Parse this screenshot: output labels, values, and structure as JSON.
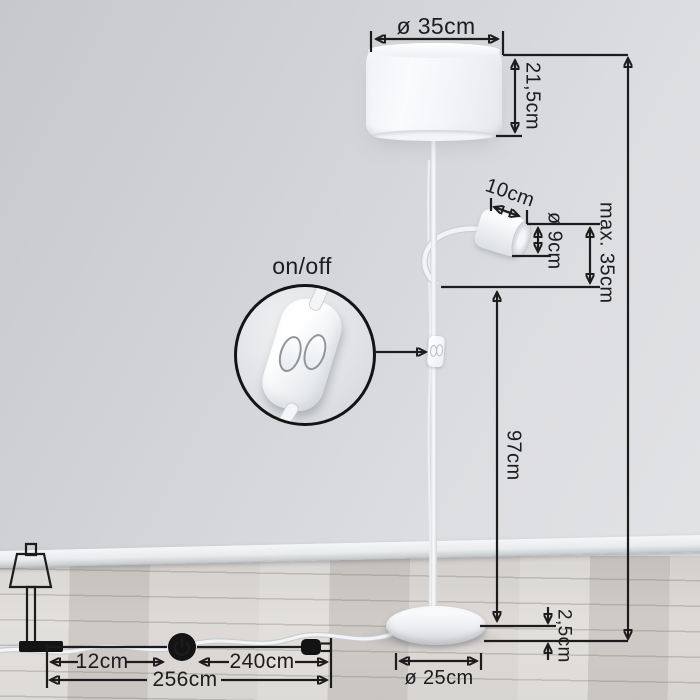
{
  "dims": {
    "shade_diameter": "ø 35cm",
    "shade_height": "21,5cm",
    "reading_light_length": "10cm",
    "reading_light_diameter": "ø 9cm",
    "reading_light_max_height": "max. 35cm",
    "total_max_height": "max. 160cm",
    "stem_height": "97cm",
    "base_thickness": "2,5cm",
    "base_diameter": "ø 25cm"
  },
  "cable": {
    "lamp_to_switch": "12cm",
    "switch_to_plug": "240cm",
    "total_length": "256cm"
  },
  "inset": {
    "label": "on/off"
  },
  "icons": {
    "power_switch": "power-icon",
    "plug": "plug-icon",
    "lamp_silhouette": "table-lamp-icon"
  },
  "colors": {
    "annotation": "#1c1c1c",
    "wall": "#d4d5d9",
    "floor": "#d5d2ce",
    "lamp": "#f5f6f8"
  }
}
